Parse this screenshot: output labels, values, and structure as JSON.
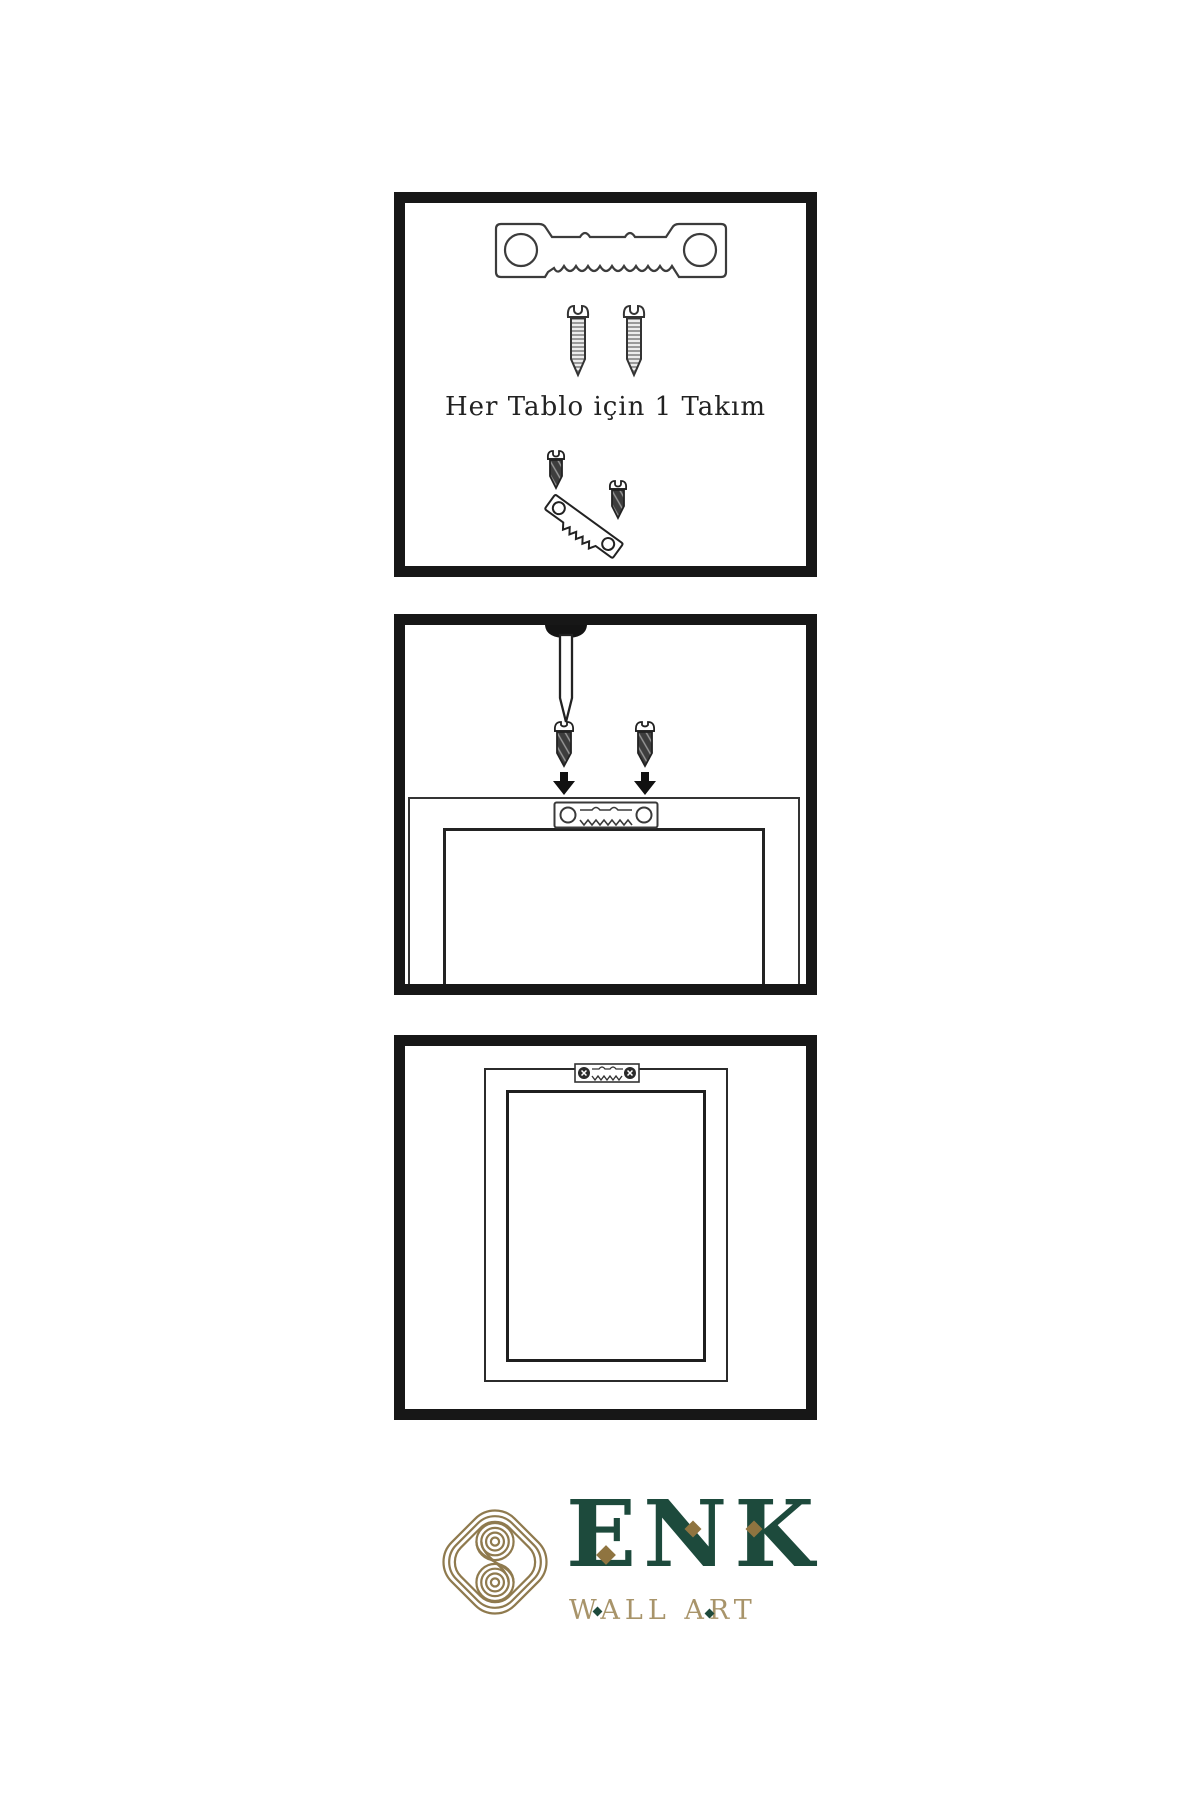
{
  "step1": {
    "caption": "Her Tablo için 1 Takım"
  },
  "brand": {
    "name": "ENK",
    "tagline": "WALL ART"
  },
  "colors": {
    "ink": "#171717",
    "line": "#3c3c3c",
    "brand_green": "#1d4a3c",
    "brand_gold": "#8f7440",
    "brand_gold_light": "#a8946a"
  },
  "icons": {
    "step1": [
      "sawtooth-hanger",
      "screw",
      "screw",
      "screw-into-sawtooth-hanger"
    ],
    "step2": [
      "wall-nail",
      "screw",
      "screw",
      "arrow-down",
      "arrow-down",
      "frame-back-with-sawtooth-hanger"
    ],
    "step3": [
      "hung-frame-with-sawtooth-hanger"
    ]
  }
}
